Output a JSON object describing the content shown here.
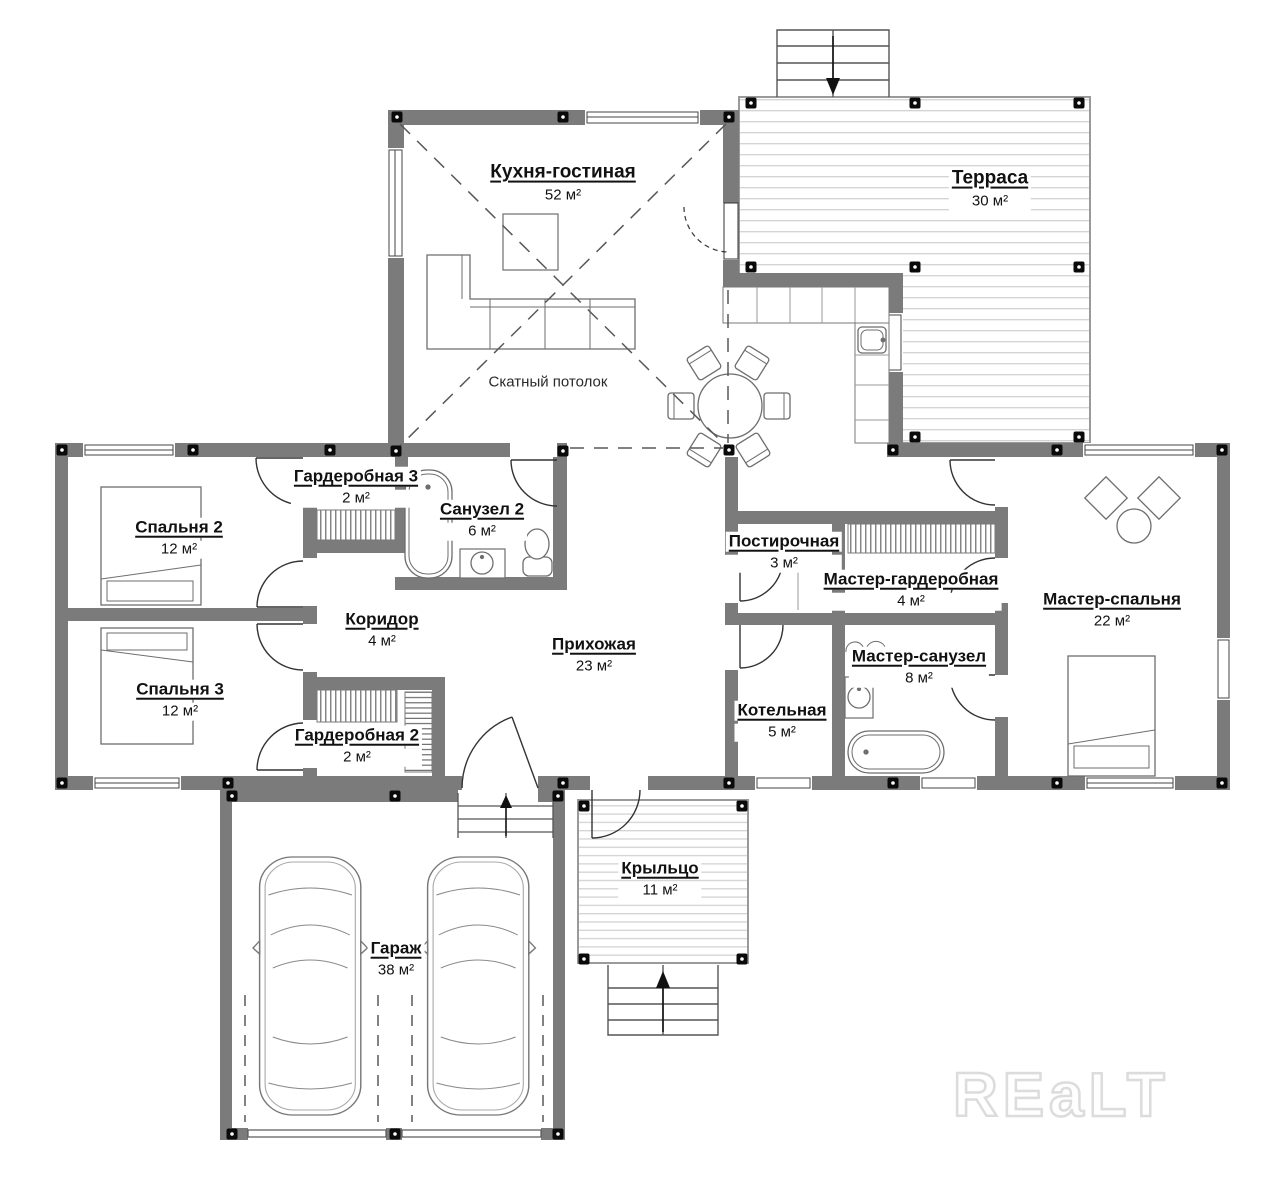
{
  "plan": {
    "rooms": {
      "kitchen_living": {
        "name": "Кухня-гостиная",
        "area": "52 м²"
      },
      "terrace": {
        "name": "Терраса",
        "area": "30 м²"
      },
      "bedroom2": {
        "name": "Спальня 2",
        "area": "12 м²"
      },
      "wardrobe3": {
        "name": "Гардеробная 3",
        "area": "2 м²"
      },
      "bathroom2": {
        "name": "Санузел 2",
        "area": "6 м²"
      },
      "corridor": {
        "name": "Коридор",
        "area": "4 м²"
      },
      "hallway": {
        "name": "Прихожая",
        "area": "23 м²"
      },
      "laundry": {
        "name": "Постирочная",
        "area": "3 м²"
      },
      "master_wardrobe": {
        "name": "Мастер-гардеробная",
        "area": "4 м²"
      },
      "master_bathroom": {
        "name": "Мастер-санузел",
        "area": "8 м²"
      },
      "boiler": {
        "name": "Котельная",
        "area": "5 м²"
      },
      "master_bedroom": {
        "name": "Мастер-спальня",
        "area": "22 м²"
      },
      "bedroom3": {
        "name": "Спальня 3",
        "area": "12 м²"
      },
      "wardrobe2": {
        "name": "Гардеробная 2",
        "area": "2 м²"
      },
      "garage": {
        "name": "Гараж",
        "area": "38 м²"
      },
      "porch": {
        "name": "Крыльцо",
        "area": "11 м²"
      }
    },
    "notes": {
      "sloped_ceiling": "Скатный потолок"
    },
    "watermark": "REaLT",
    "colors": {
      "wall": "#7b7b7b",
      "post": "#0a0a0a",
      "furniture_line": "#6e6e6e",
      "deck_line": "#d4d4d4",
      "dash_line": "#585858",
      "background": "#ffffff"
    }
  }
}
